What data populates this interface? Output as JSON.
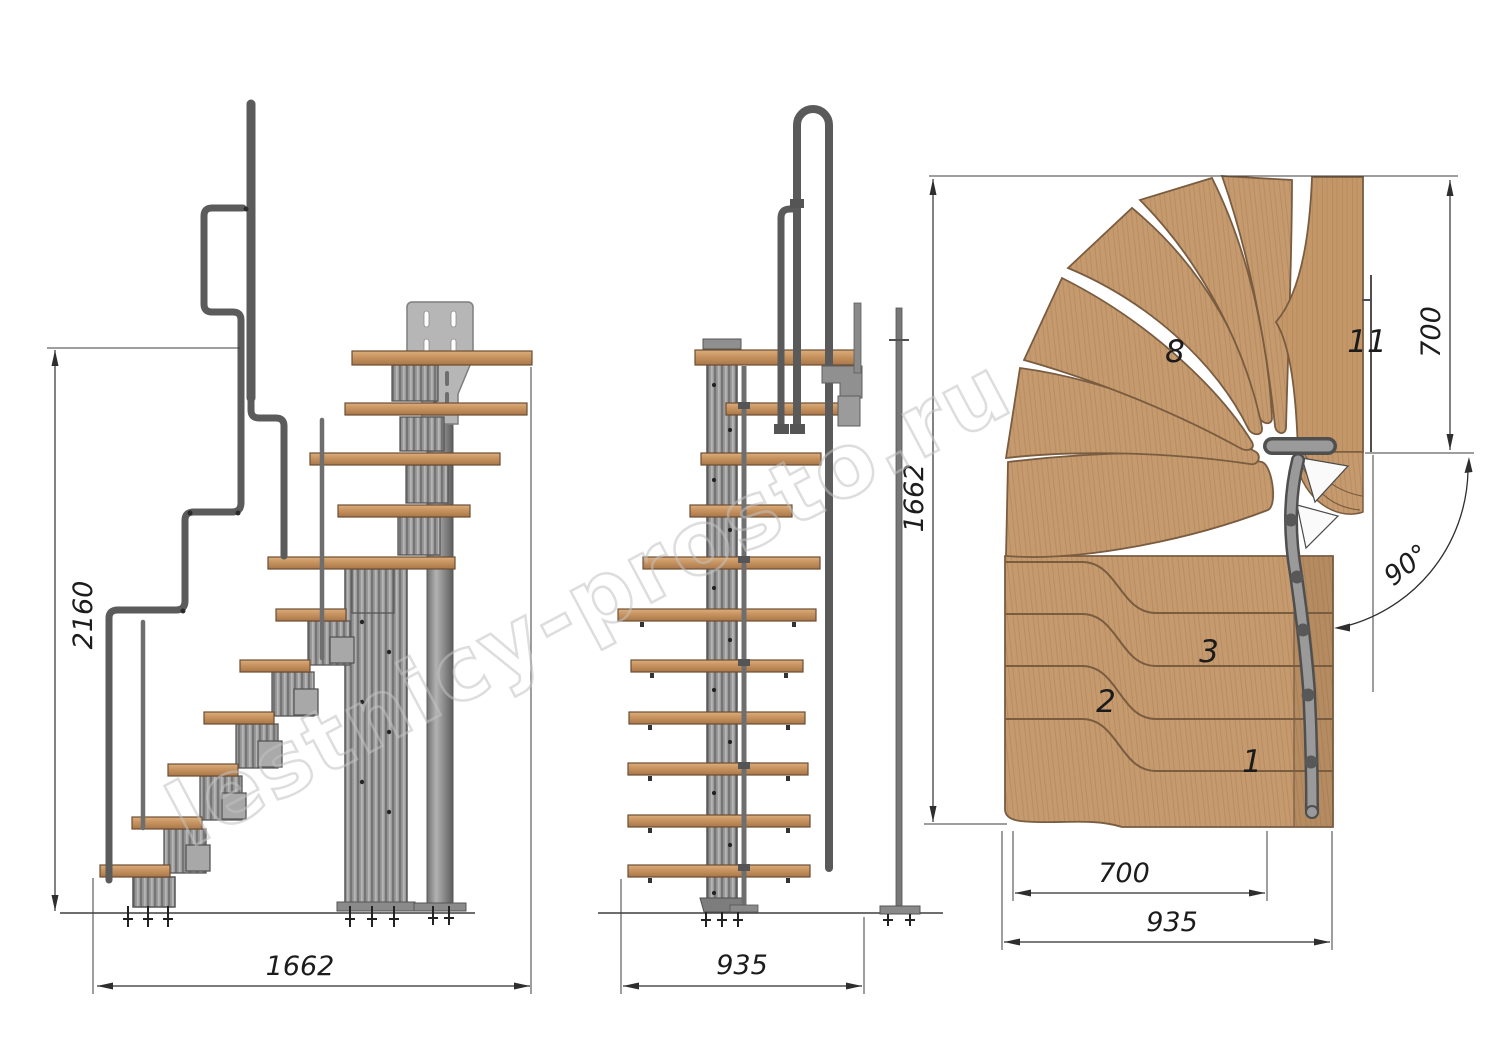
{
  "watermark": {
    "text": "lestnicy-prosto.ru"
  },
  "side_view": {
    "height_dim": "2160",
    "length_dim": "1662"
  },
  "front_view": {
    "width_dim": "935"
  },
  "plan_view": {
    "depth_dim": "1662",
    "tread_width_dim": "700",
    "total_width_dim": "935",
    "landing_width_dim": "700",
    "turn_angle": "90°",
    "step_labels": [
      "1",
      "2",
      "3",
      "8",
      "11"
    ]
  },
  "colors": {
    "background": "#ffffff",
    "wood_plan": "#c59a6e",
    "wood_tread": "#c4905c",
    "metal_mid": "#8c8c8c",
    "metal_dark": "#555555",
    "plate_gray": "#b6b6b6",
    "dim_line": "#2e2e2e",
    "watermark_stroke": "#c3c3c3"
  }
}
